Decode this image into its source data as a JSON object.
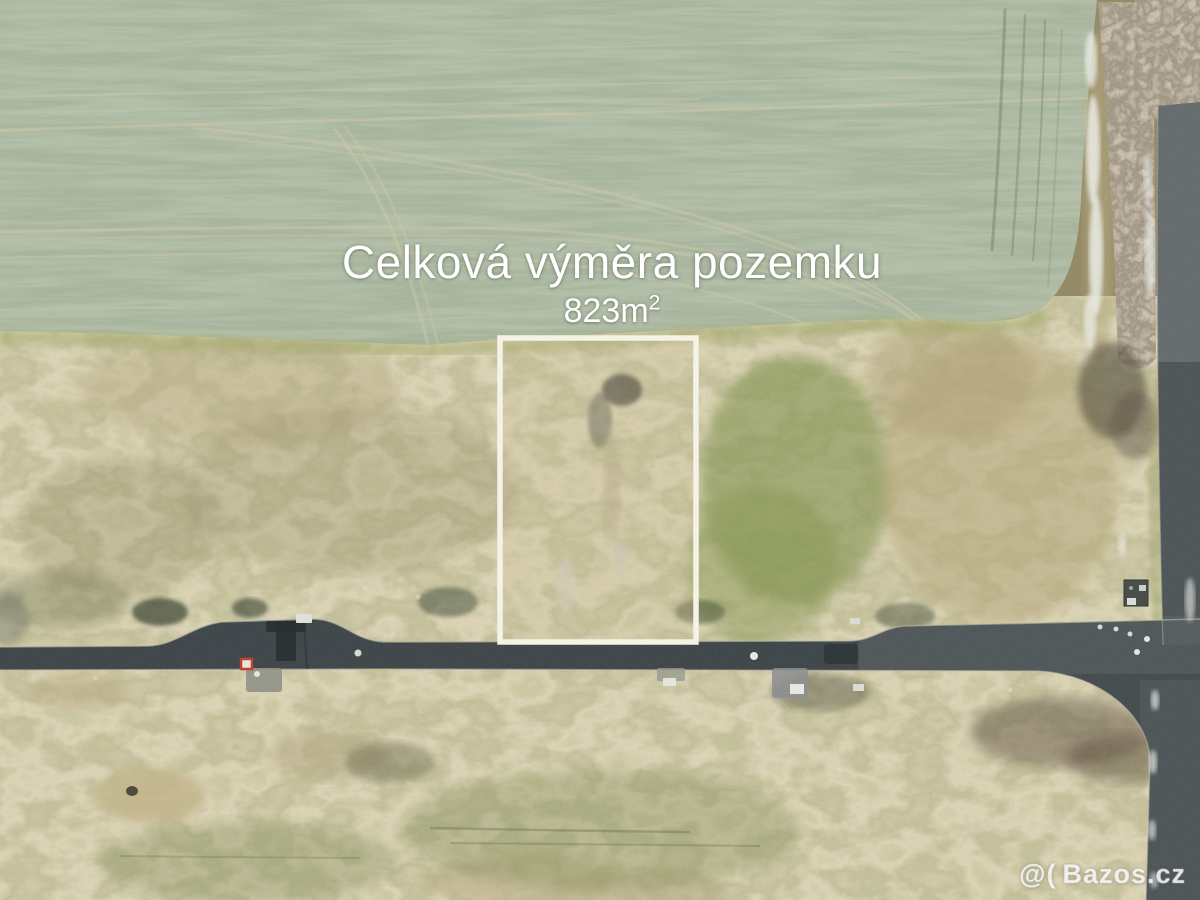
{
  "photo": {
    "type": "aerial-drone-photo-of-building-plot",
    "caption_line1": "Celková výměra pozemku",
    "caption_area_value": "823m",
    "caption_area_exponent": "2",
    "watermark_symbol": "@(",
    "watermark_text": "Bazos.cz"
  },
  "colors": {
    "field_green": "#66755d",
    "scrub_tan": "#a89a72",
    "scrub_olive": "#7e7f52",
    "road_asphalt": "#41484c",
    "road_light": "#6b7476",
    "plot_outline_white": "#f4f1e6",
    "tree_brown": "#6e5f4f",
    "snow_white": "#e9ebe5",
    "caption_color": "#ffffff",
    "marker_red": "#c0392b"
  }
}
